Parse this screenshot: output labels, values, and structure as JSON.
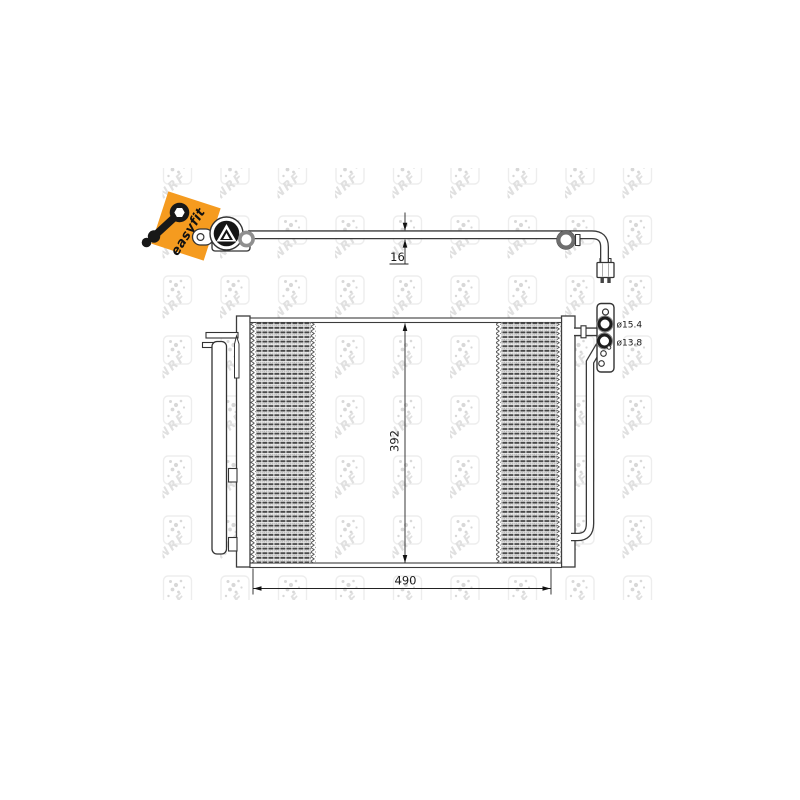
{
  "drawing": {
    "watermark_text": "NRF",
    "badge": {
      "label": "easyfit",
      "bg_color": "#F59B1F"
    },
    "dims": {
      "pipe_thickness": "16",
      "core_height": "392",
      "core_width": "490",
      "port_top": "ø15.4",
      "port_bottom": "ø13.8"
    },
    "colors": {
      "line": "#3a3a3a",
      "hatch": "#454545",
      "watermark": "#e0e0e0"
    }
  }
}
